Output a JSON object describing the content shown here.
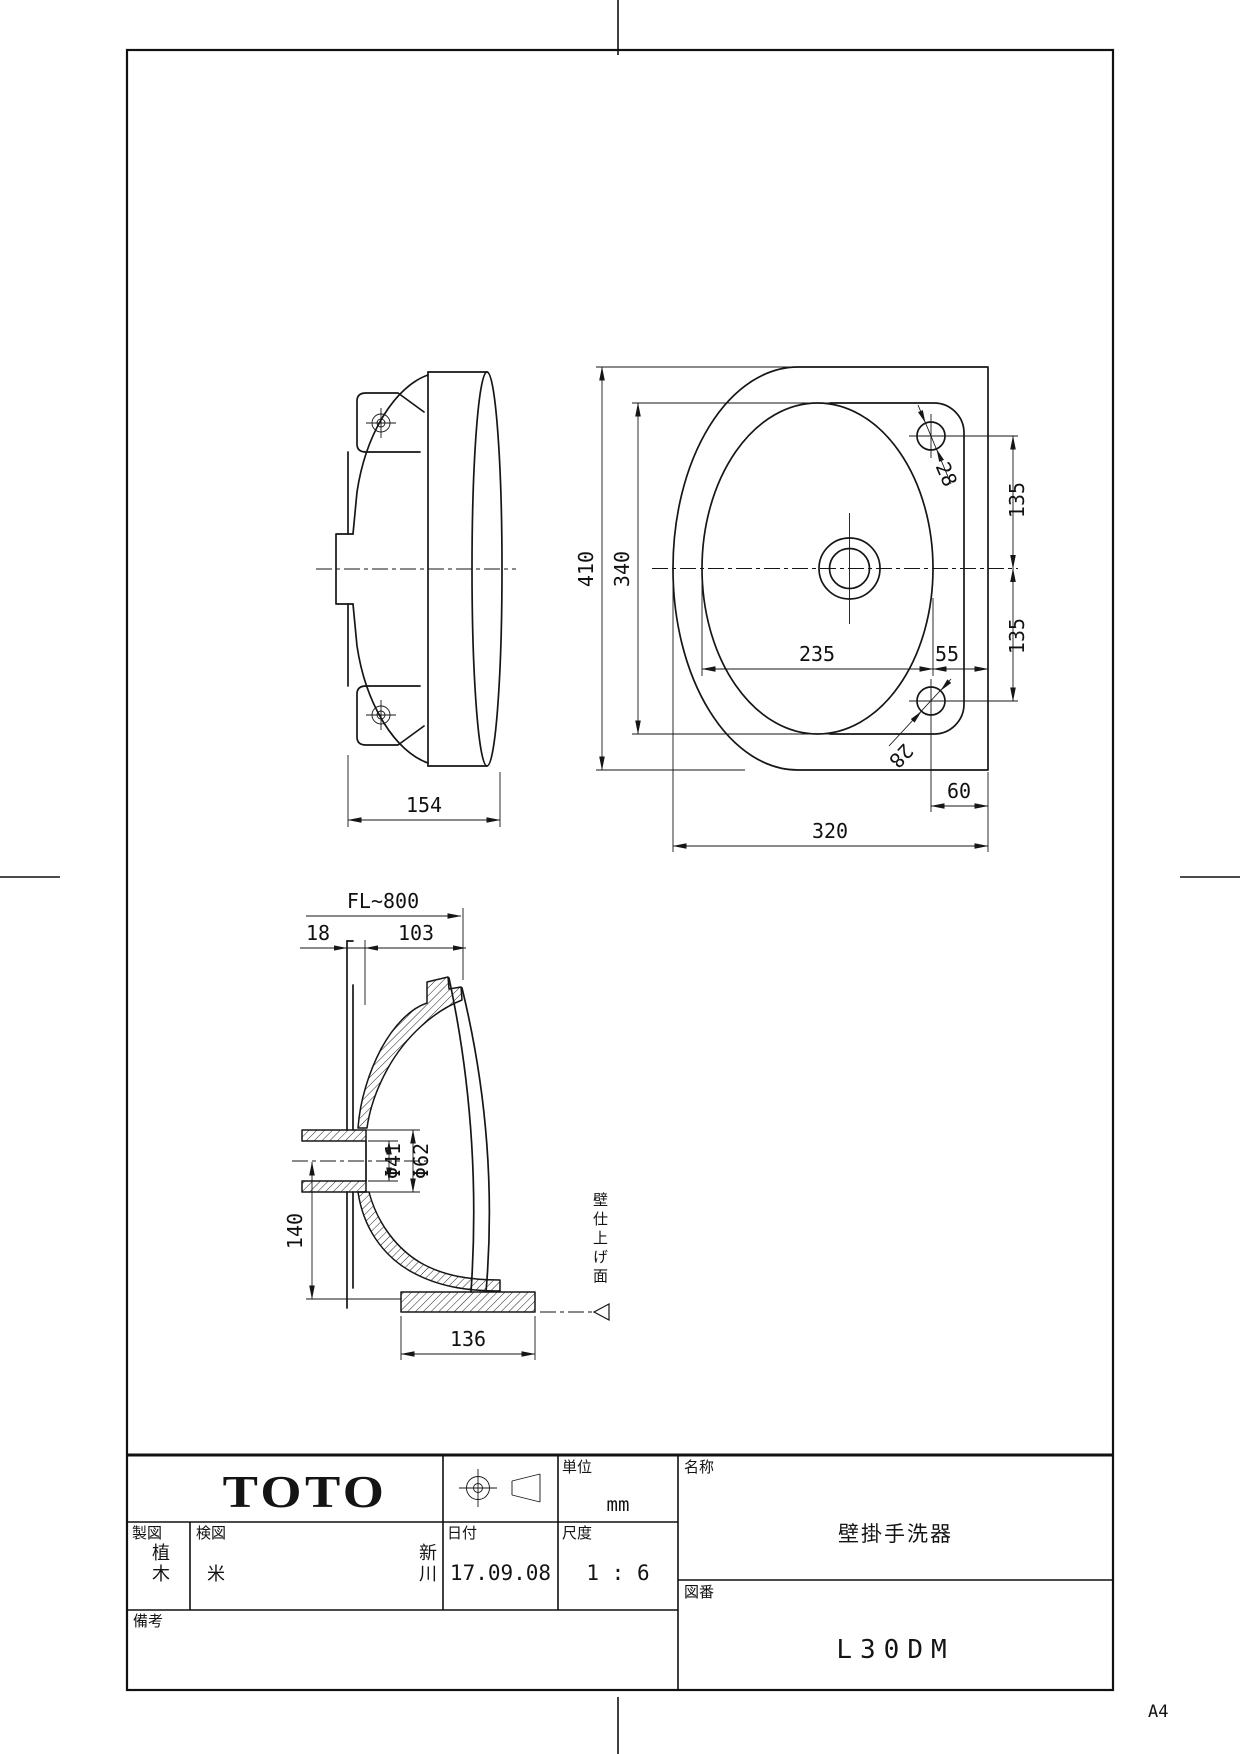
{
  "sheet": {
    "size_label": "A4"
  },
  "title_block": {
    "logo": "TOTO",
    "drafter_label": "製図",
    "drafter_value": "植木",
    "checker_label": "検図",
    "checker_value_1": "米",
    "checker_value_2": "新川",
    "date_label": "日付",
    "date_value": "17.09.08",
    "scale_label": "尺度",
    "scale_value": "1 : 6",
    "unit_label": "単位",
    "unit_value": "mm",
    "name_label": "名称",
    "name_value": "壁掛手洗器",
    "number_label": "図番",
    "number_value": "L30DM",
    "remarks_label": "備考"
  },
  "dimensions": {
    "side": {
      "depth": "154"
    },
    "plan": {
      "overall_height": "410",
      "basin_height": "340",
      "basin_width": "235",
      "deck_width": "55",
      "hole_dia_top": "28",
      "hole_dia_bottom": "28",
      "hole_offset_top": "135",
      "hole_offset_bottom": "135",
      "hole_to_edge": "60",
      "overall_width": "320"
    },
    "section": {
      "floor_height": "FL~800",
      "back_offset": "18",
      "front_offset": "103",
      "drain_outer_dia": "Φ62",
      "drain_inner_dia": "Φ41",
      "drain_depth": "140",
      "base_width": "136",
      "wall_surface_label": "壁仕上げ面"
    }
  }
}
